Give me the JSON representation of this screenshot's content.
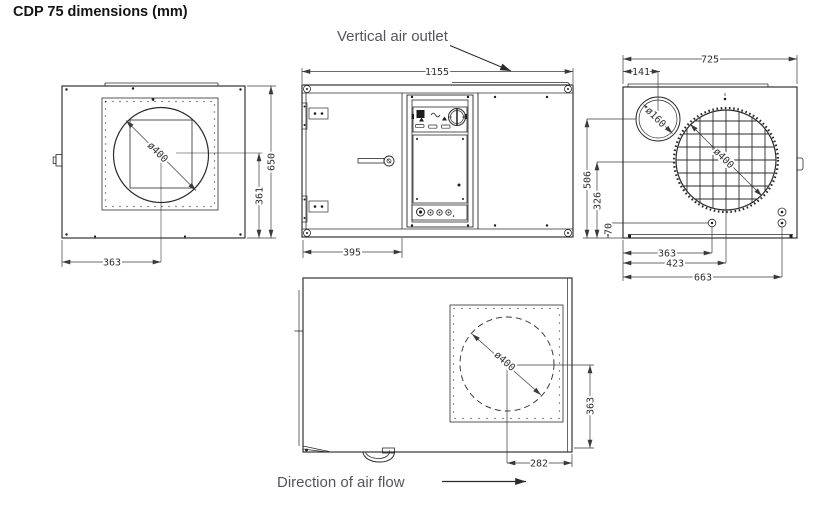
{
  "title": "CDP 75 dimensions (mm)",
  "annotations": {
    "vertical_air_outlet": "Vertical air outlet",
    "direction_of_air_flow": "Direction of air flow"
  },
  "colors": {
    "line": "#2b2b2b",
    "dimension_text": "#2f2f2f",
    "annotation_text": "#55565a"
  },
  "side_view": {
    "overall_height": "650",
    "fan_center_to_bottom": "361",
    "fan_center_from_left": "363",
    "fan_diameter": "ø400"
  },
  "front_view": {
    "overall_width": "1155",
    "left_edge_to_control_panel": "395"
  },
  "end_view": {
    "overall_width": "725",
    "inlet_center_from_left": "141",
    "inlet_diameter": "ø160",
    "fan_diameter": "ø400",
    "inlet_center_height": "506",
    "fan_center_height": "326",
    "drain_height": "70",
    "drain_from_left": "363",
    "fan_center_from_left": "423",
    "connections_from_left": "663"
  },
  "top_view": {
    "fan_diameter": "ø400",
    "fan_center_to_front_edge": "363",
    "fan_center_to_right_edge": "282"
  }
}
